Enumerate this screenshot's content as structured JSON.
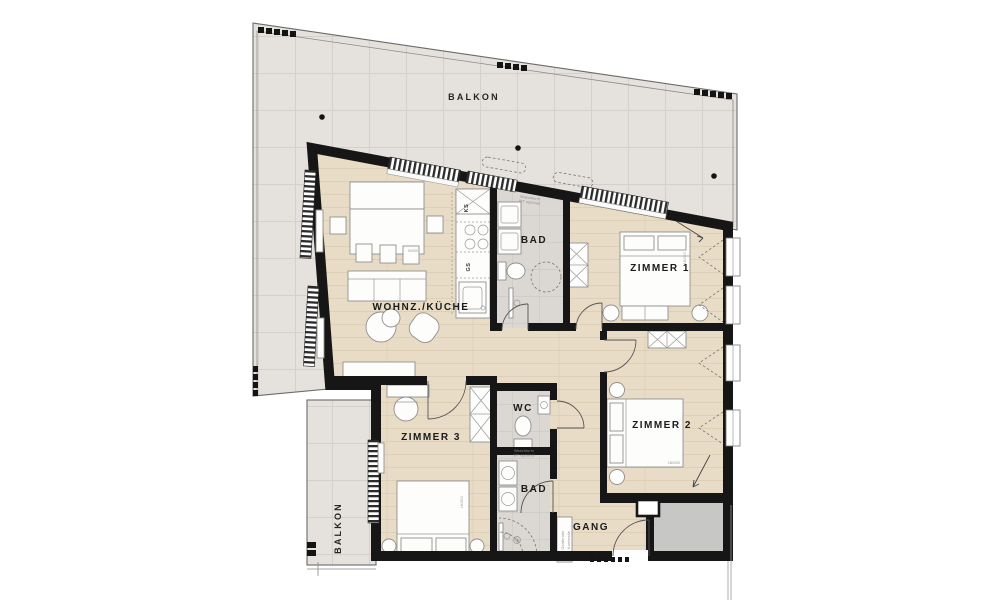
{
  "labels": {
    "balkon_top": "BALKON",
    "balkon_left": "BALKON",
    "wohnzimmer_kueche": "WOHNZ./KÜCHE",
    "bad_upper": "BAD",
    "bad_lower": "BAD",
    "zimmer1": "ZIMMER 1",
    "zimmer2": "ZIMMER 2",
    "zimmer3": "ZIMMER 3",
    "wc": "WC",
    "gang": "GANG"
  },
  "kitchen": {
    "fridge": "KS",
    "dishwasher": "GS"
  },
  "annotations": {
    "washtower_line1": "Waschturm",
    "washtower_line2": "WT optional",
    "wardrobe": "Garderobe",
    "dresser": "Kommode",
    "bed_dim": "180/200",
    "table_dim": "90/200"
  },
  "colors": {
    "wall": "#161616",
    "wood_floor": "#e9dcc6",
    "balcony_tile": "#e5e2de",
    "bath_floor": "#dbd7d3",
    "corridor_gray": "#c7c7c6",
    "background": "#ffffff"
  }
}
